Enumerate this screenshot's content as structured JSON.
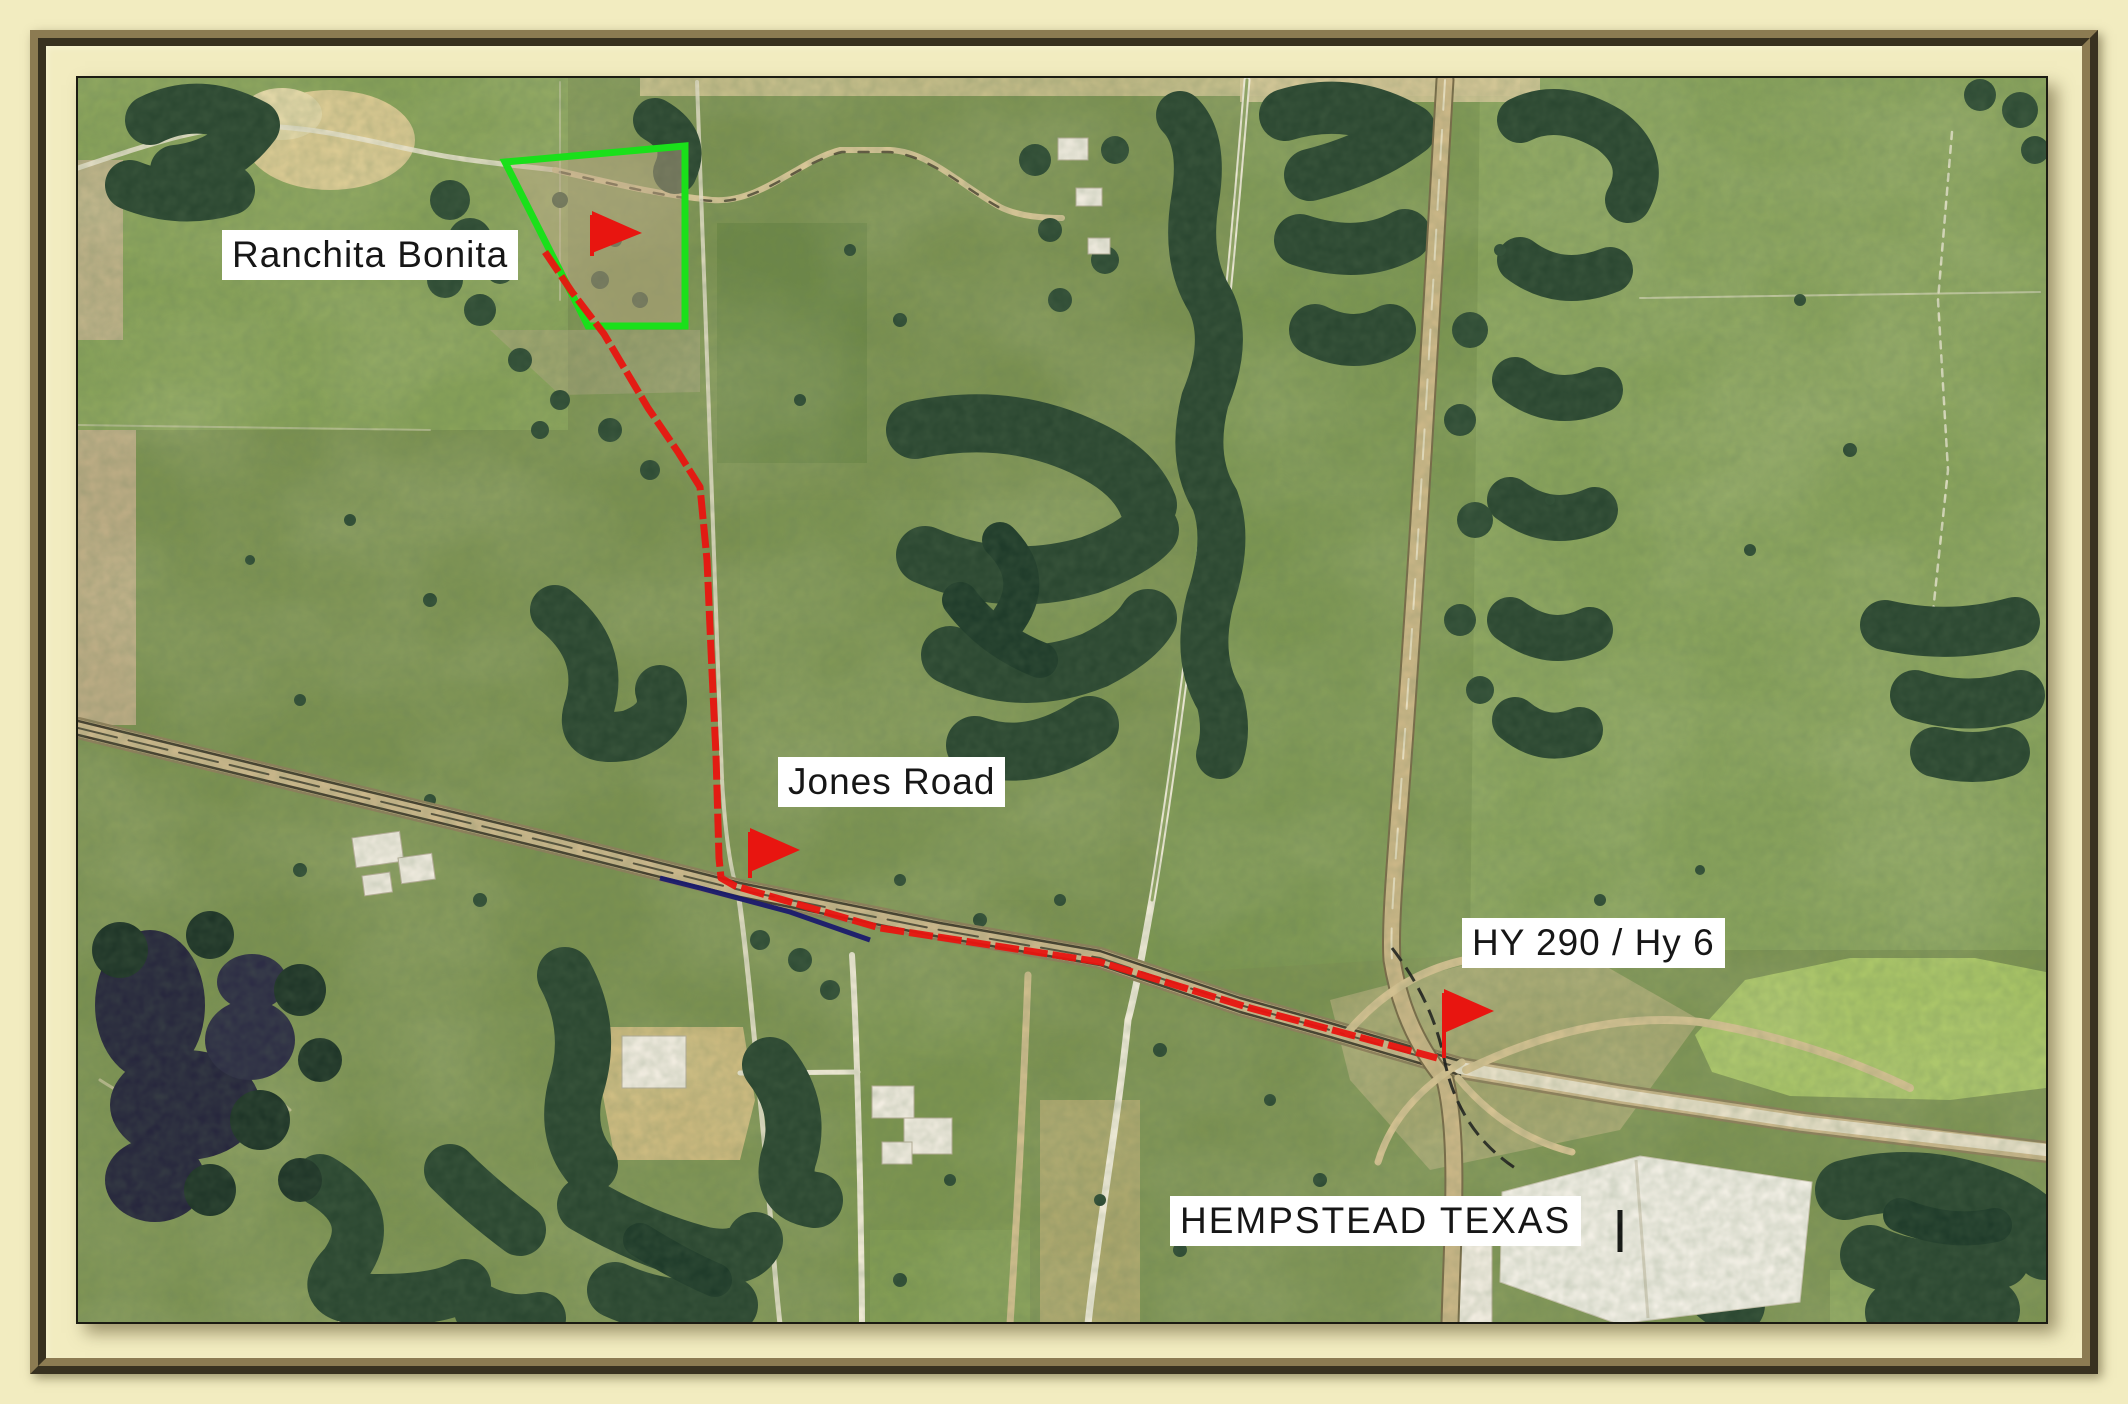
{
  "map": {
    "description": "Aerial photo route map with driving route from ranch to highway interchange",
    "labels": {
      "property": "Ranchita Bonita",
      "road_junction": "Jones Road",
      "highway_junction": "HY 290 / Hy 6",
      "city": "HEMPSTEAD TEXAS"
    },
    "markers": [
      {
        "id": "property-flag",
        "at": "Ranchita Bonita"
      },
      {
        "id": "jones-road-flag",
        "at": "Jones Road"
      },
      {
        "id": "highway-flag",
        "at": "HY 290 / Hy 6"
      }
    ],
    "colors": {
      "route": "#e81510",
      "boundary": "#1ae01a",
      "marker": "#e81510",
      "pipeline": "#1a1a6e",
      "label_bg": "#ffffff",
      "label_fg": "#161616",
      "mat": "#f2ecc0",
      "bevel": "#8c7b52"
    }
  }
}
